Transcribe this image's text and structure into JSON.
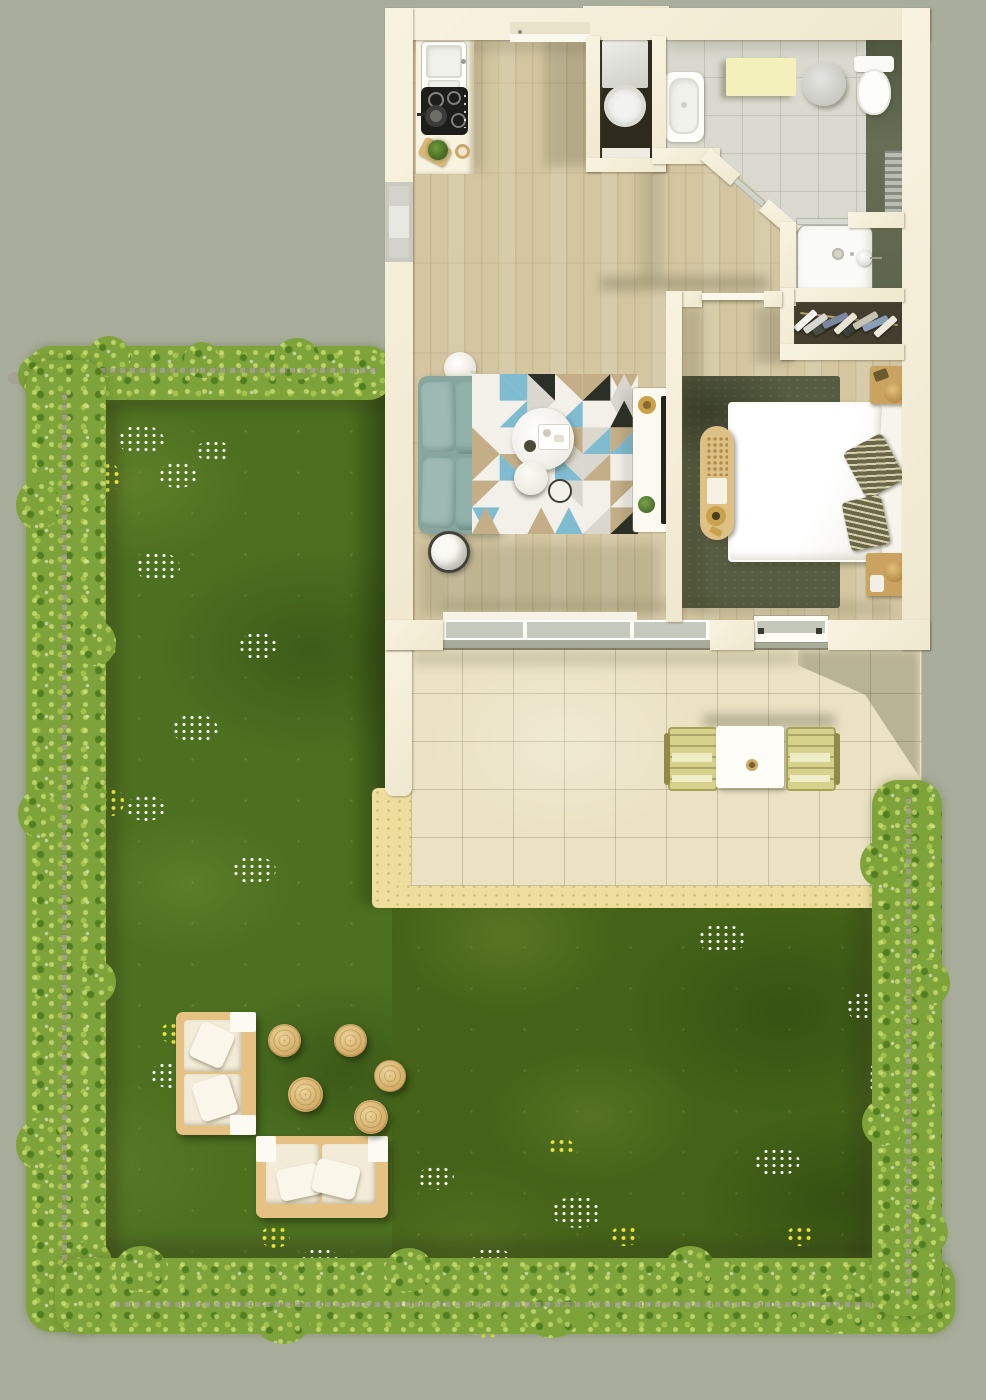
{
  "scene": {
    "view": "top-down-3d-floor-plan-render",
    "areas": [
      {
        "name": "kitchen-living-room",
        "objects": [
          "kitchen-counter-with-sink",
          "cooktop-with-pan",
          "cutting-board",
          "potted-herb",
          "entrance-door",
          "teal-two-seat-sofa",
          "geometric-triangle-rug",
          "round-coffee-table-with-tray",
          "small-round-tables",
          "floor-lamp",
          "dark-drum-side-table",
          "media-console-with-tv-and-speaker",
          "sliding-glass-door"
        ]
      },
      {
        "name": "utility-closet",
        "objects": [
          "washing-machine",
          "shelf"
        ]
      },
      {
        "name": "bathroom",
        "objects": [
          "washbasin",
          "yellow-storage-bench",
          "round-stool",
          "toilet",
          "radiator",
          "walk-in-shower",
          "glass-partition"
        ]
      },
      {
        "name": "wardrobe-closet",
        "objects": [
          "clothes-rail-with-hanging-clothes"
        ]
      },
      {
        "name": "bedroom",
        "objects": [
          "double-bed-white-duvet",
          "white-pillows",
          "olive-striped-cushions",
          "bedside-table-with-lamp-top",
          "bedside-table-with-lamp-bottom",
          "upholstered-bench",
          "olive-rug",
          "window"
        ]
      },
      {
        "name": "terrace",
        "objects": [
          "square-dining-table",
          "garden-chair-left",
          "garden-chair-right",
          "low-garden-wall"
        ]
      },
      {
        "name": "garden",
        "objects": [
          "wooden-lounge-sofa-vertical",
          "wooden-lounge-sofa-horizontal",
          "round-wood-stool-1",
          "round-wood-stool-2",
          "round-wood-stool-3",
          "round-wood-stool-4",
          "round-wood-stool-5"
        ],
        "landscape": [
          "lawn-with-wildflowers",
          "flowering-hedge-border",
          "low-stone-wall",
          "sand-border"
        ]
      }
    ]
  },
  "palette": {
    "background": "#a9ae9c",
    "walls": "#f5efda",
    "wood_floor": "#d3c6a1",
    "bath_tile": "#d9d9cf",
    "bath_accent_dark": "#616850",
    "patio_tile": "#ebe2c3",
    "sand": "#eede9d",
    "grass": "#4d7020",
    "hedge": "#7ea33a",
    "sofa_teal": "#8fb1a9",
    "bedroom_rug": "#565c41",
    "furniture_wood": "#d2ab66",
    "cushion_cream": "#f1ebd7",
    "chair_yellow": "#d7d28b",
    "cabinet_yellow": "#f4f0bc"
  },
  "rug_pattern_colors": {
    "base": "#f2f0e9",
    "teal": "#7fbcd0",
    "dark": "#2c2f26",
    "tan": "#c4ae88",
    "grey": "#d9d7ce"
  },
  "closet_clothes_colors": [
    "#f2f2ee",
    "#d8d8d2",
    "#4a4e42",
    "#7b86a0",
    "#e8e4d4",
    "#3c3f35",
    "#c9c4b2",
    "#8aa0b8",
    "#ece9dc"
  ]
}
